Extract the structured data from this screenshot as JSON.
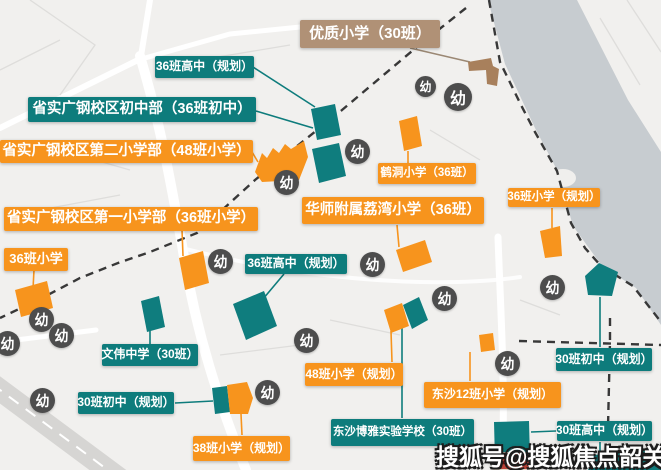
{
  "map": {
    "kindergarten_glyph": "幼",
    "watermark": "搜狐号@搜狐焦点韶关站",
    "project_site_label": "本案",
    "colors": {
      "middle_high_school_teal": "#0e7c7c",
      "primary_school_orange": "#f7941d",
      "quality_primary_tan": "#b09176",
      "kindergarten_gray": "#4d4d4d",
      "project_red": "#c1453a",
      "river_gray": "#c7ccd0"
    }
  },
  "schools": {
    "planned_hs_top": "36班高中（规划）",
    "shengshi_junior": "省实广钢校区初中部（36班初中）",
    "shengshi_primary2": "省实广钢校区第二小学部（48班小学）",
    "shengshi_primary1": "省实广钢校区第一小学部（36班小学）",
    "xs36_left": "36班小学",
    "youzhi": "优质小学（30班）",
    "hedong": "鹤洞小学（36班）",
    "huashi": "华师附属荔湾小学（36班）",
    "xs36_planned_right": "36班小学（规划）",
    "planned_hs_mid": "36班高中（规划）",
    "wenwei": "文伟中学（30班）",
    "planned_jh_left": "30班初中（规划）",
    "xs38_planned": "38班小学（规划）",
    "xs48_planned": "48班小学（规划）",
    "dongsha12": "东沙12班小学（规划）",
    "dongsha_boya": "东沙博雅实验学校（30班）",
    "planned_jh_right": "30班初中（规划）",
    "planned_hs_right": "30班高中（规划）"
  }
}
